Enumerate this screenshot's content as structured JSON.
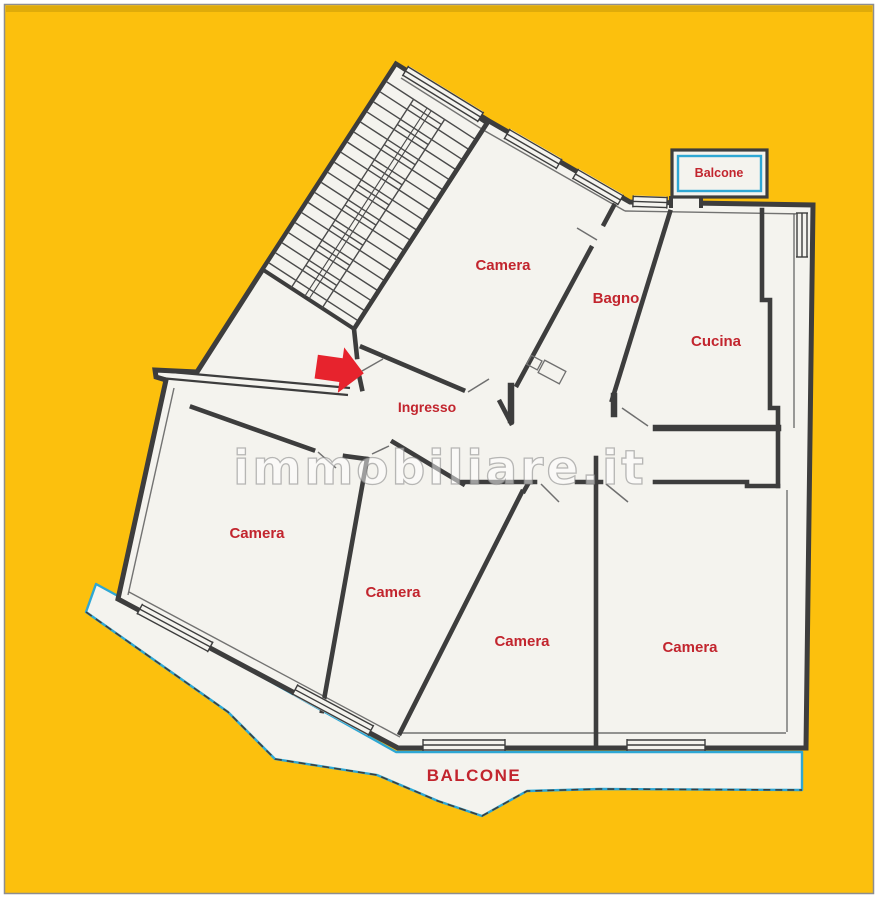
{
  "plan": {
    "watermark": "immobiliare.it",
    "labels": {
      "camera_top": "Camera",
      "bagno": "Bagno",
      "cucina": "Cucina",
      "ingresso": "Ingresso",
      "camera_left": "Camera",
      "camera_mid": "Camera",
      "camera_bottom_mid": "Camera",
      "camera_bottom_right": "Camera",
      "balcone_top": "Balcone",
      "balcone_bottom": "BALCONE"
    },
    "colors": {
      "background": "#fcc00d",
      "background_band": "#d9a70b",
      "frame_border": "#8e8e8e",
      "paper": "#f4f3ee",
      "wall": "#3d3d3d",
      "label": "#c2252e",
      "balcony": "#2ea7d4",
      "arrow": "#e7232d",
      "watermark": "#9a9a9a"
    }
  }
}
